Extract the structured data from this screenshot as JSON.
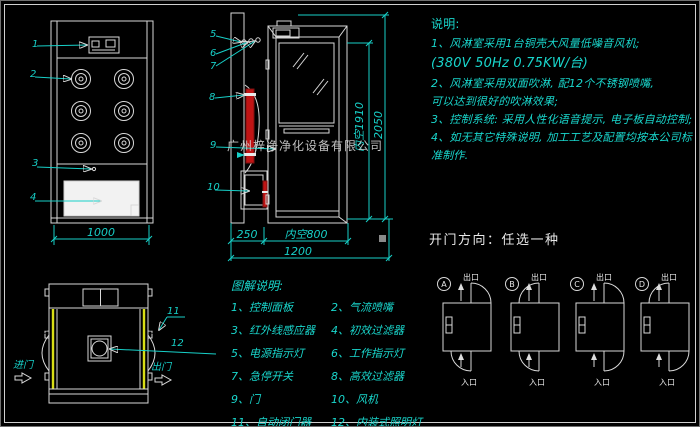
{
  "watermark": "广州梓净净化设备有限公司",
  "notes": {
    "title": "说明:",
    "lines": [
      "1、风淋室采用1台铜壳大风量低噪音风机;",
      "(380V  50Hz  0.75KW/台)",
      "2、风淋室采用双面吹淋, 配12个不锈钢喷嘴,",
      "可以达到很好的吹淋效果;",
      "3、控制系统: 采用人性化语音提示, 电子板自动控制;",
      "4、如无其它特殊说明, 加工工艺及配置均按本公司标准制作."
    ]
  },
  "door_direction": {
    "title": "开门方向：任选一种",
    "exit_label": "出口",
    "entry_label": "入口",
    "options": [
      "A",
      "B",
      "C",
      "D"
    ]
  },
  "legend": {
    "title": "图解说明:",
    "items": [
      "1、控制面板",
      "2、气流喷嘴",
      "3、红外线感应器",
      "4、初效过滤器",
      "5、电源指示灯",
      "6、工作指示灯",
      "7、急停开关",
      "8、高效过滤器",
      "9、门",
      "10、风机",
      "11、自动闭门器",
      "12、内装式照明灯"
    ]
  },
  "dimensions": {
    "front_width": "1000",
    "depth": "250",
    "inner_width": "内空800",
    "total_width": "1200",
    "inner_height": "内空1910",
    "total_height": "2050"
  },
  "top_view": {
    "enter": "进门",
    "exit": "出门"
  },
  "callouts": {
    "c1": "1",
    "c2": "2",
    "c3": "3",
    "c4": "4",
    "c5": "5",
    "c6": "6",
    "c7": "7",
    "c8": "8",
    "c9": "9",
    "c10": "10",
    "c11": "11",
    "c12": "12"
  }
}
